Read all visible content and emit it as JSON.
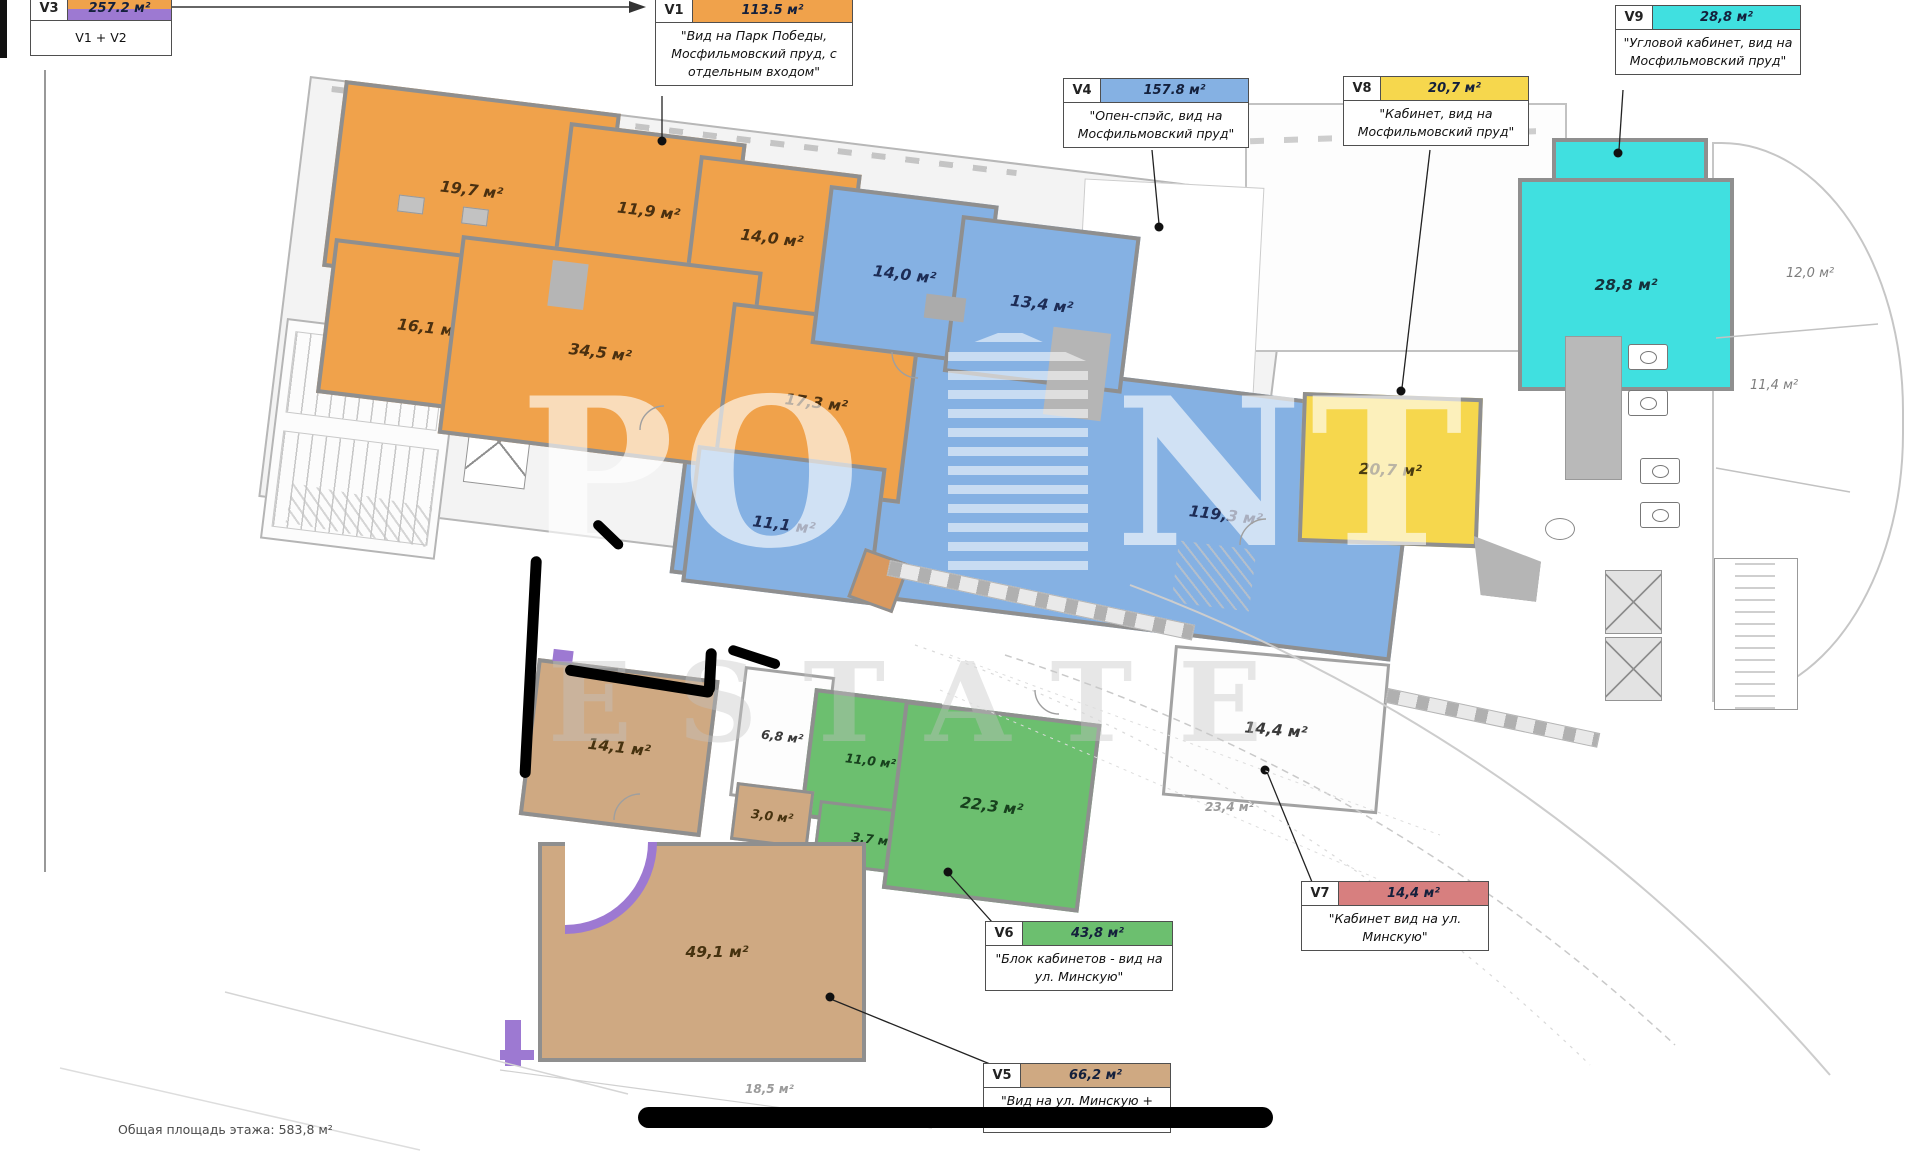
{
  "legend": {
    "v3": {
      "id": "V3",
      "area": "257.2 м²",
      "note": "V1 + V2"
    },
    "v1": {
      "id": "V1",
      "area": "113.5 м²",
      "note": "\"Вид на Парк Победы, Мосфильмовский пруд, с отдельным входом\""
    },
    "v4": {
      "id": "V4",
      "area": "157.8 м²",
      "note": "\"Опен-спэйс, вид на Мосфильмовский пруд\""
    },
    "v8": {
      "id": "V8",
      "area": "20,7 м²",
      "note": "\"Кабинет, вид на Мосфильмовский пруд\""
    },
    "v9": {
      "id": "V9",
      "area": "28,8 м²",
      "note": "\"Угловой кабинет, вид на Мосфильмовский пруд\""
    },
    "v7": {
      "id": "V7",
      "area": "14,4 м²",
      "note": "\"Кабинет вид на ул. Минскую\""
    },
    "v6": {
      "id": "V6",
      "area": "43,8 м²",
      "note": "\"Блок кабинетов - вид на ул. Минскую\""
    },
    "v5": {
      "id": "V5",
      "area": "66,2 м²",
      "note": "\"Вид на ул. Минскую + терраса 18,5 м²\""
    }
  },
  "rooms": {
    "r19_7": {
      "label": "19,7 м²"
    },
    "r11_9": {
      "label": "11,9 м²"
    },
    "r14_0a": {
      "label": "14,0 м²"
    },
    "r16_1": {
      "label": "16,1 м²"
    },
    "r34_5": {
      "label": "34,5 м²"
    },
    "r17_3": {
      "label": "17,3 м²"
    },
    "r14_0b": {
      "label": "14,0 м²"
    },
    "r13_4": {
      "label": "13,4 м²"
    },
    "r119_3": {
      "label": "119,3 м²"
    },
    "r11_1": {
      "label": "11,1 м²"
    },
    "r28_8": {
      "label": "28,8 м²"
    },
    "r20_7": {
      "label": "20,7 м²"
    },
    "r12_0": {
      "label": "12,0 м²"
    },
    "r11_4": {
      "label": "11,4 м²"
    },
    "r14_1": {
      "label": "14,1 м²"
    },
    "r6_8": {
      "label": "6,8 м²"
    },
    "r11_0": {
      "label": "11,0 м²"
    },
    "r3_0": {
      "label": "3,0 м²"
    },
    "r3_7": {
      "label": "3,7 м²"
    },
    "r22_3": {
      "label": "22,3 м²"
    },
    "r14_4": {
      "label": "14,4 м²"
    },
    "r23_4": {
      "label": "23,4 м²"
    },
    "r49_1": {
      "label": "49,1 м²"
    },
    "r18_5": {
      "label": "18,5 м²"
    }
  },
  "watermark": {
    "po": "PO",
    "nt": "NT",
    "estate": "ESTATE",
    "word": "POINT ESTATE"
  },
  "footer": {
    "total_area": "Общая площадь этажа: 583,8 м²"
  },
  "colors": {
    "orange": "#f0a24b",
    "blue": "#85b1e3",
    "cyan": "#40e0e0",
    "yellow": "#f6d74d",
    "green": "#6cbf6f",
    "tan": "#cfa982",
    "red": "#d77f7f",
    "purple": "#9d79d2",
    "wall": "#8f8f8f"
  }
}
